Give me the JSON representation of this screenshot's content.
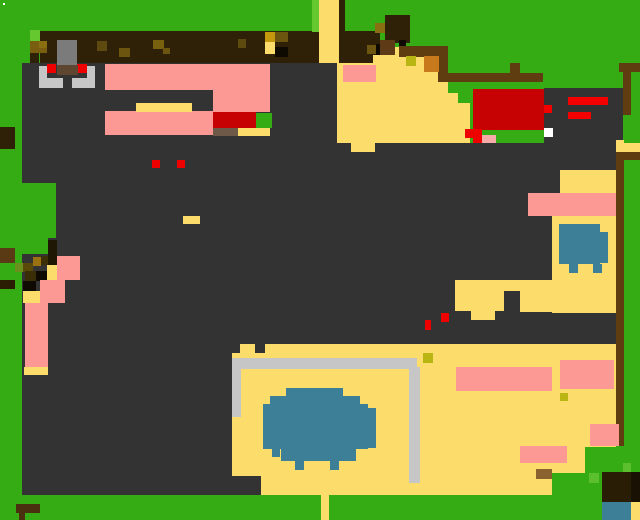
{
  "canvas": {
    "width": 640,
    "height": 520,
    "background_color_name": "grass",
    "scene_kind": "pixel-art overhead game map"
  },
  "palette": {
    "GRASS": "#35AC14",
    "LIME": "#64C82E",
    "LIME2": "#5BBF2E",
    "WHITE": "#FFFFFF",
    "BAND": "#2F2108",
    "FLOOR": "#333333",
    "Y": "#FCDD6C",
    "PINK": "#FC9995",
    "LPINK": "#F7ACA9",
    "RED": "#C60202",
    "RED2": "#EE0000",
    "RED3": "#F40000",
    "BLUE": "#3D7F97",
    "SILV": "#C6C6C6",
    "STGRAY": "#7B7B7B",
    "SADDLE": "#5E4630",
    "FENCE": "#5F3D11",
    "FBROWN": "#5E3A16",
    "ORANGE": "#C8791C",
    "CITRON": "#B9B513",
    "GBR": "#6E5848",
    "TAN": "#8A6230",
    "TRUNK": "#201604",
    "TREE": "#2A1D05",
    "TREE2": "#191204",
    "BRL": "#4A300E",
    "BR2": "#5A3A14",
    "GOLD1": "#7A5E10",
    "GOLD2": "#8A6E12",
    "GOLD3": "#9A7212",
    "GOLDB": "#C4990E",
    "OL1": "#5E4A0E",
    "OL2": "#6B550F",
    "OL3": "#77610E",
    "LO": "#6B8E1C",
    "DO1": "#3E3006",
    "DO2": "#5A4A0A",
    "DO3": "#3A2E06",
    "DBAR": "#2A1D04",
    "BLK": "#150F03",
    "BLK2": "#0E0A02"
  },
  "scene": {
    "blocks": [
      [
        3,
        3,
        2,
        2,
        "WHITE",
        "speck"
      ],
      [
        40,
        31,
        340,
        33,
        "BAND",
        "dirt-path-top"
      ],
      [
        312,
        0,
        7,
        32,
        "LIME",
        "grass-highlight-stripe"
      ],
      [
        319,
        0,
        20,
        64,
        "Y",
        "sand-path-vertical"
      ],
      [
        339,
        0,
        6,
        31,
        "BAND",
        "tree-trunk-top"
      ],
      [
        30,
        30,
        10,
        11,
        "LIME",
        "bush-highlight"
      ],
      [
        30,
        41,
        17,
        12,
        "GOLD1",
        "bush-gold"
      ],
      [
        39,
        41,
        8,
        7,
        "GOLD2",
        "bush-gold-light"
      ],
      [
        30,
        53,
        9,
        10,
        "BAND",
        "bush-shadow"
      ],
      [
        26,
        63,
        10,
        9,
        "BLK",
        "bush-dark"
      ],
      [
        97,
        41,
        10,
        10,
        "OL1",
        "path-spot"
      ],
      [
        119,
        48,
        11,
        9,
        "OL2",
        "path-spot"
      ],
      [
        153,
        40,
        11,
        9,
        "OL3",
        "path-spot"
      ],
      [
        163,
        48,
        7,
        6,
        "OL2",
        "path-spot"
      ],
      [
        238,
        39,
        8,
        9,
        "OL1",
        "path-spot"
      ],
      [
        265,
        32,
        10,
        10,
        "GOLDB",
        "path-chest"
      ],
      [
        275,
        32,
        13,
        10,
        "OL2",
        "path-spot"
      ],
      [
        265,
        42,
        10,
        12,
        "Y",
        "path-sand-spot"
      ],
      [
        275,
        47,
        13,
        10,
        "BLK2",
        "path-hole"
      ],
      [
        22,
        63,
        315,
        80,
        "FLOOR",
        "floor-upper"
      ],
      [
        22,
        143,
        594,
        353,
        "FLOOR",
        "floor-main"
      ],
      [
        57,
        40,
        20,
        26,
        "STGRAY",
        "statue"
      ],
      [
        47,
        64,
        9,
        9,
        "RED2",
        "statue-eye-left"
      ],
      [
        77,
        64,
        10,
        9,
        "RED2",
        "statue-eye-right"
      ],
      [
        57,
        65,
        21,
        10,
        "SADDLE",
        "statue-base"
      ],
      [
        39,
        66,
        8,
        22,
        "SILV",
        "statue-rail-left"
      ],
      [
        47,
        78,
        16,
        10,
        "SILV",
        "statue-rail-left-foot"
      ],
      [
        87,
        66,
        8,
        22,
        "SILV",
        "statue-rail-right"
      ],
      [
        72,
        78,
        15,
        10,
        "SILV",
        "statue-rail-right-foot"
      ],
      [
        105,
        64,
        165,
        26,
        "PINK",
        "rug-top"
      ],
      [
        213,
        88,
        57,
        24,
        "PINK",
        "rug-right"
      ],
      [
        105,
        111,
        108,
        24,
        "PINK",
        "rug-bottom"
      ],
      [
        136,
        103,
        56,
        9,
        "Y",
        "table"
      ],
      [
        213,
        112,
        43,
        16,
        "RED",
        "red-machine"
      ],
      [
        256,
        113,
        16,
        15,
        "GRASS",
        "green-crate"
      ],
      [
        213,
        128,
        25,
        8,
        "GBR",
        "crate-brown"
      ],
      [
        238,
        128,
        32,
        8,
        "Y",
        "crate-sand"
      ],
      [
        0,
        183,
        56,
        55,
        "GRASS",
        "grass-inlet"
      ],
      [
        0,
        238,
        48,
        16,
        "GRASS",
        "grass-inlet2"
      ],
      [
        48,
        240,
        9,
        25,
        "TRUNK",
        "tree-trunk"
      ],
      [
        0,
        248,
        15,
        15,
        "BR2",
        "log"
      ],
      [
        33,
        257,
        8,
        9,
        "GOLD3",
        "bush2-gold"
      ],
      [
        41,
        256,
        7,
        9,
        "DO1",
        "bush2-dark"
      ],
      [
        15,
        263,
        8,
        9,
        "LO",
        "bush2-leaf"
      ],
      [
        23,
        263,
        10,
        9,
        "DO2",
        "bush2-olive"
      ],
      [
        25,
        271,
        11,
        10,
        "DO3",
        "bush2-olive-dark"
      ],
      [
        36,
        271,
        11,
        10,
        "BLK2",
        "bush2-black"
      ],
      [
        47,
        265,
        10,
        15,
        "Y",
        "sand-patch"
      ],
      [
        0,
        280,
        15,
        9,
        "DBAR",
        "log-dark"
      ],
      [
        23,
        281,
        13,
        10,
        "BLK2",
        "bush2-black2"
      ],
      [
        23,
        291,
        17,
        12,
        "Y",
        "sand-patch2"
      ],
      [
        57,
        256,
        23,
        24,
        "PINK",
        "rug-small"
      ],
      [
        40,
        280,
        25,
        23,
        "PINK",
        "rug-small2"
      ],
      [
        25,
        303,
        23,
        64,
        "PINK",
        "rug-column"
      ],
      [
        24,
        367,
        24,
        8,
        "Y",
        "sand-strip"
      ],
      [
        0,
        127,
        15,
        22,
        "BAND",
        "wall-notch"
      ],
      [
        183,
        216,
        17,
        8,
        "Y",
        "table-small"
      ],
      [
        152,
        160,
        8,
        8,
        "RED2",
        "red-item"
      ],
      [
        177,
        160,
        8,
        8,
        "RED2",
        "red-item"
      ],
      [
        337,
        63,
        89,
        80,
        "Y",
        "sand-yard"
      ],
      [
        343,
        65,
        33,
        17,
        "PINK",
        "rug-sand-yard"
      ],
      [
        351,
        143,
        24,
        9,
        "Y",
        "sand-tab"
      ],
      [
        373,
        55,
        29,
        9,
        "Y",
        "sand-edge"
      ],
      [
        395,
        47,
        7,
        9,
        "Y",
        "sand-edge2"
      ],
      [
        400,
        56,
        26,
        8,
        "Y",
        "sand-edge3"
      ],
      [
        426,
        56,
        12,
        87,
        "Y",
        "sand-right"
      ],
      [
        438,
        82,
        10,
        61,
        "Y",
        "sand-step1"
      ],
      [
        448,
        93,
        10,
        50,
        "Y",
        "sand-step2"
      ],
      [
        458,
        103,
        12,
        40,
        "Y",
        "sand-step3"
      ],
      [
        385,
        15,
        25,
        28,
        "BAND",
        "tree-canopy"
      ],
      [
        375,
        23,
        10,
        10,
        "GOLD2",
        "tree-gold"
      ],
      [
        367,
        45,
        9,
        9,
        "OL2",
        "tree-spot"
      ],
      [
        376,
        44,
        9,
        11,
        "BLK2",
        "tree-hole"
      ],
      [
        380,
        40,
        15,
        15,
        "FBROWN",
        "tree-branch"
      ],
      [
        399,
        40,
        7,
        6,
        "BLK2",
        "tree-hole2"
      ],
      [
        399,
        46,
        49,
        11,
        "FENCE",
        "fence-top"
      ],
      [
        438,
        56,
        10,
        18,
        "FENCE",
        "fence-leg"
      ],
      [
        438,
        73,
        105,
        9,
        "FENCE",
        "fence-bar"
      ],
      [
        510,
        63,
        10,
        10,
        "FENCE",
        "fence-post"
      ],
      [
        406,
        56,
        10,
        10,
        "CITRON",
        "item-citron"
      ],
      [
        424,
        56,
        15,
        16,
        "ORANGE",
        "item-crate-orange"
      ],
      [
        619,
        63,
        21,
        9,
        "FENCE",
        "fence-corner-top"
      ],
      [
        623,
        63,
        8,
        52,
        "FENCE",
        "fence-corner-side"
      ],
      [
        473,
        89,
        71,
        41,
        "RED",
        "red-roof"
      ],
      [
        465,
        129,
        9,
        9,
        "RED2",
        "red-flower"
      ],
      [
        473,
        129,
        9,
        14,
        "RED2",
        "red-flower2"
      ],
      [
        482,
        135,
        14,
        8,
        "LPINK",
        "pink-flower"
      ],
      [
        544,
        88,
        79,
        55,
        "FLOOR",
        "dark-roof"
      ],
      [
        568,
        97,
        40,
        8,
        "RED3",
        "roof-stripe1"
      ],
      [
        568,
        112,
        23,
        7,
        "RED3",
        "roof-stripe2"
      ],
      [
        544,
        105,
        8,
        8,
        "RED3",
        "roof-tab"
      ],
      [
        544,
        128,
        9,
        9,
        "WHITE",
        "roof-white"
      ],
      [
        616,
        140,
        8,
        3,
        "Y",
        "sand-notch"
      ],
      [
        616,
        143,
        24,
        9,
        "Y",
        "sand-corner"
      ],
      [
        616,
        152,
        24,
        8,
        "FENCE",
        "fence-right-bar"
      ],
      [
        616,
        160,
        8,
        286,
        "FENCE",
        "fence-right-strip"
      ],
      [
        560,
        170,
        56,
        23,
        "Y",
        "sand-room-top"
      ],
      [
        528,
        193,
        88,
        23,
        "PINK",
        "rug-wide"
      ],
      [
        552,
        216,
        64,
        97,
        "Y",
        "sand-room-right"
      ],
      [
        559,
        224,
        41,
        40,
        "BLUE",
        "pond-small"
      ],
      [
        600,
        232,
        8,
        31,
        "BLUE",
        "pond-small-bump"
      ],
      [
        569,
        264,
        9,
        9,
        "BLUE",
        "pond-small-foot"
      ],
      [
        593,
        264,
        9,
        9,
        "BLUE",
        "pond-small-foot2"
      ],
      [
        455,
        280,
        97,
        11,
        "Y",
        "sand-path-h"
      ],
      [
        455,
        280,
        49,
        31,
        "Y",
        "sand-path-chunk"
      ],
      [
        520,
        288,
        32,
        24,
        "Y",
        "sand-path-chunk2"
      ],
      [
        471,
        311,
        24,
        9,
        "Y",
        "sand-path-tab"
      ],
      [
        425,
        320,
        6,
        10,
        "RED2",
        "red-item2"
      ],
      [
        441,
        313,
        8,
        9,
        "RED2",
        "red-item3"
      ],
      [
        240,
        344,
        15,
        10,
        "Y",
        "room-tab"
      ],
      [
        265,
        344,
        351,
        14,
        "Y",
        "room-top-strip"
      ],
      [
        232,
        353,
        384,
        142,
        "Y",
        "room-floor"
      ],
      [
        232,
        358,
        185,
        11,
        "SILV",
        "pen-rail-top"
      ],
      [
        232,
        358,
        9,
        59,
        "SILV",
        "pen-rail-left"
      ],
      [
        409,
        367,
        11,
        116,
        "SILV",
        "pen-rail-right"
      ],
      [
        286,
        388,
        57,
        8,
        "BLUE",
        "pond-big-r1"
      ],
      [
        270,
        396,
        90,
        8,
        "BLUE",
        "pond-big-r2"
      ],
      [
        263,
        404,
        105,
        45,
        "BLUE",
        "pond-big-main"
      ],
      [
        368,
        408,
        8,
        40,
        "BLUE",
        "pond-big-right"
      ],
      [
        281,
        449,
        75,
        12,
        "BLUE",
        "pond-big-low"
      ],
      [
        295,
        461,
        9,
        9,
        "BLUE",
        "pond-big-foot1"
      ],
      [
        330,
        461,
        9,
        9,
        "BLUE",
        "pond-big-foot2"
      ],
      [
        272,
        449,
        8,
        8,
        "BLUE",
        "pond-big-dot"
      ],
      [
        456,
        367,
        96,
        24,
        "PINK",
        "rug-room1"
      ],
      [
        560,
        360,
        54,
        29,
        "PINK",
        "rug-room2"
      ],
      [
        590,
        424,
        29,
        22,
        "PINK",
        "rug-room3"
      ],
      [
        520,
        446,
        47,
        17,
        "PINK",
        "rug-room4"
      ],
      [
        423,
        353,
        10,
        10,
        "CITRON",
        "item-citron2"
      ],
      [
        560,
        393,
        8,
        8,
        "CITRON",
        "item-citron3"
      ],
      [
        536,
        469,
        16,
        10,
        "TAN",
        "item-crate"
      ],
      [
        213,
        476,
        48,
        22,
        "FLOOR",
        "floor-ledge"
      ],
      [
        585,
        447,
        55,
        51,
        "GRASS",
        "grass-br1"
      ],
      [
        552,
        473,
        33,
        25,
        "GRASS",
        "grass-br2"
      ],
      [
        589,
        473,
        10,
        10,
        "LIME2",
        "grass-tuft1"
      ],
      [
        623,
        463,
        8,
        9,
        "LIME2",
        "grass-tuft2"
      ],
      [
        0,
        495,
        640,
        25,
        "GRASS",
        "grass-bottom"
      ],
      [
        16,
        504,
        24,
        9,
        "BRL",
        "bench"
      ],
      [
        19,
        513,
        6,
        7,
        "BRL",
        "bench-leg"
      ],
      [
        321,
        495,
        8,
        25,
        "Y",
        "sand-path-exit"
      ],
      [
        602,
        472,
        29,
        30,
        "TREE",
        "tree-canopy-br"
      ],
      [
        631,
        472,
        9,
        30,
        "TREE2",
        "tree-dark-br"
      ],
      [
        602,
        502,
        29,
        18,
        "BLUE",
        "pond-corner"
      ],
      [
        631,
        502,
        9,
        18,
        "Y",
        "sand-corner-br"
      ]
    ]
  }
}
